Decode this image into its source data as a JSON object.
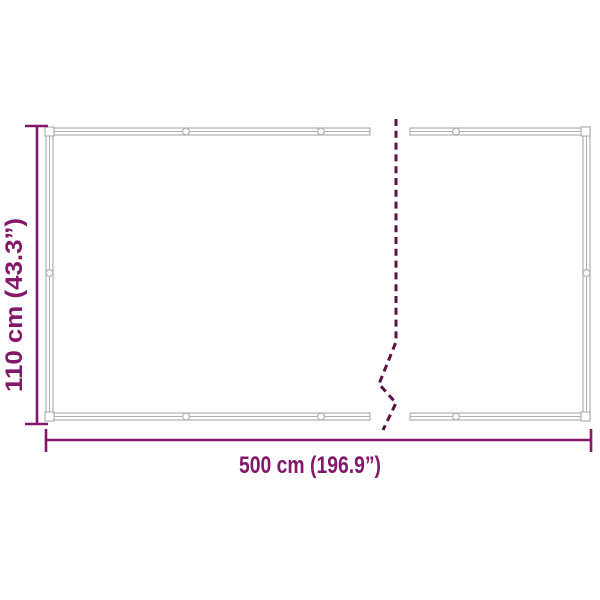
{
  "diagram": {
    "type": "product-dimension-diagram",
    "height_label": "110 cm (43.3”)",
    "width_label": "500 cm (196.9”)",
    "colors": {
      "accent": "#83186a",
      "break_line": "#5e1145",
      "frame": "#b2b0ac",
      "background": "#ffffff"
    }
  }
}
